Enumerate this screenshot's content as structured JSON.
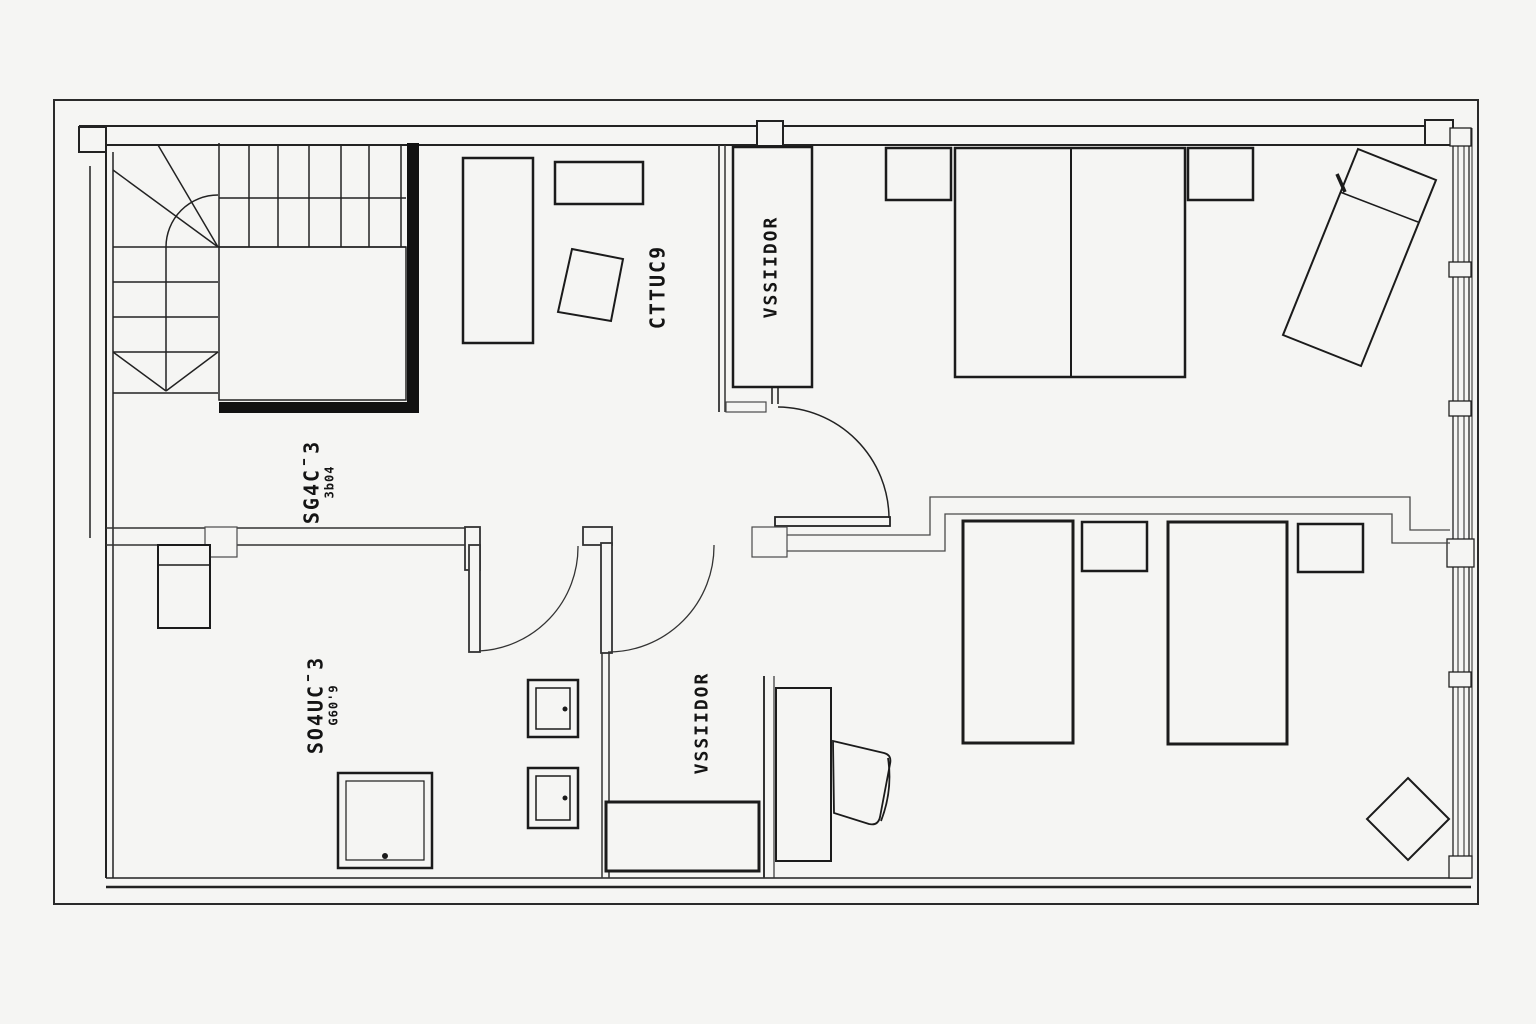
{
  "colors": {
    "background": "#f5f5f3",
    "furniture_line": "#1b1b1b",
    "exterior_wall": "#222222",
    "thin_wall": "#4a4a4a"
  },
  "labels": {
    "study": "CTTUC9",
    "dressing_top": "VSSIIDOR",
    "corridor_bottom": "VSSIIDOR",
    "room_left": {
      "main": "SG4C¯3",
      "sub": "3b04"
    },
    "room_lower_left": {
      "main": "SO4UC¯3",
      "sub": "G60'9"
    }
  }
}
